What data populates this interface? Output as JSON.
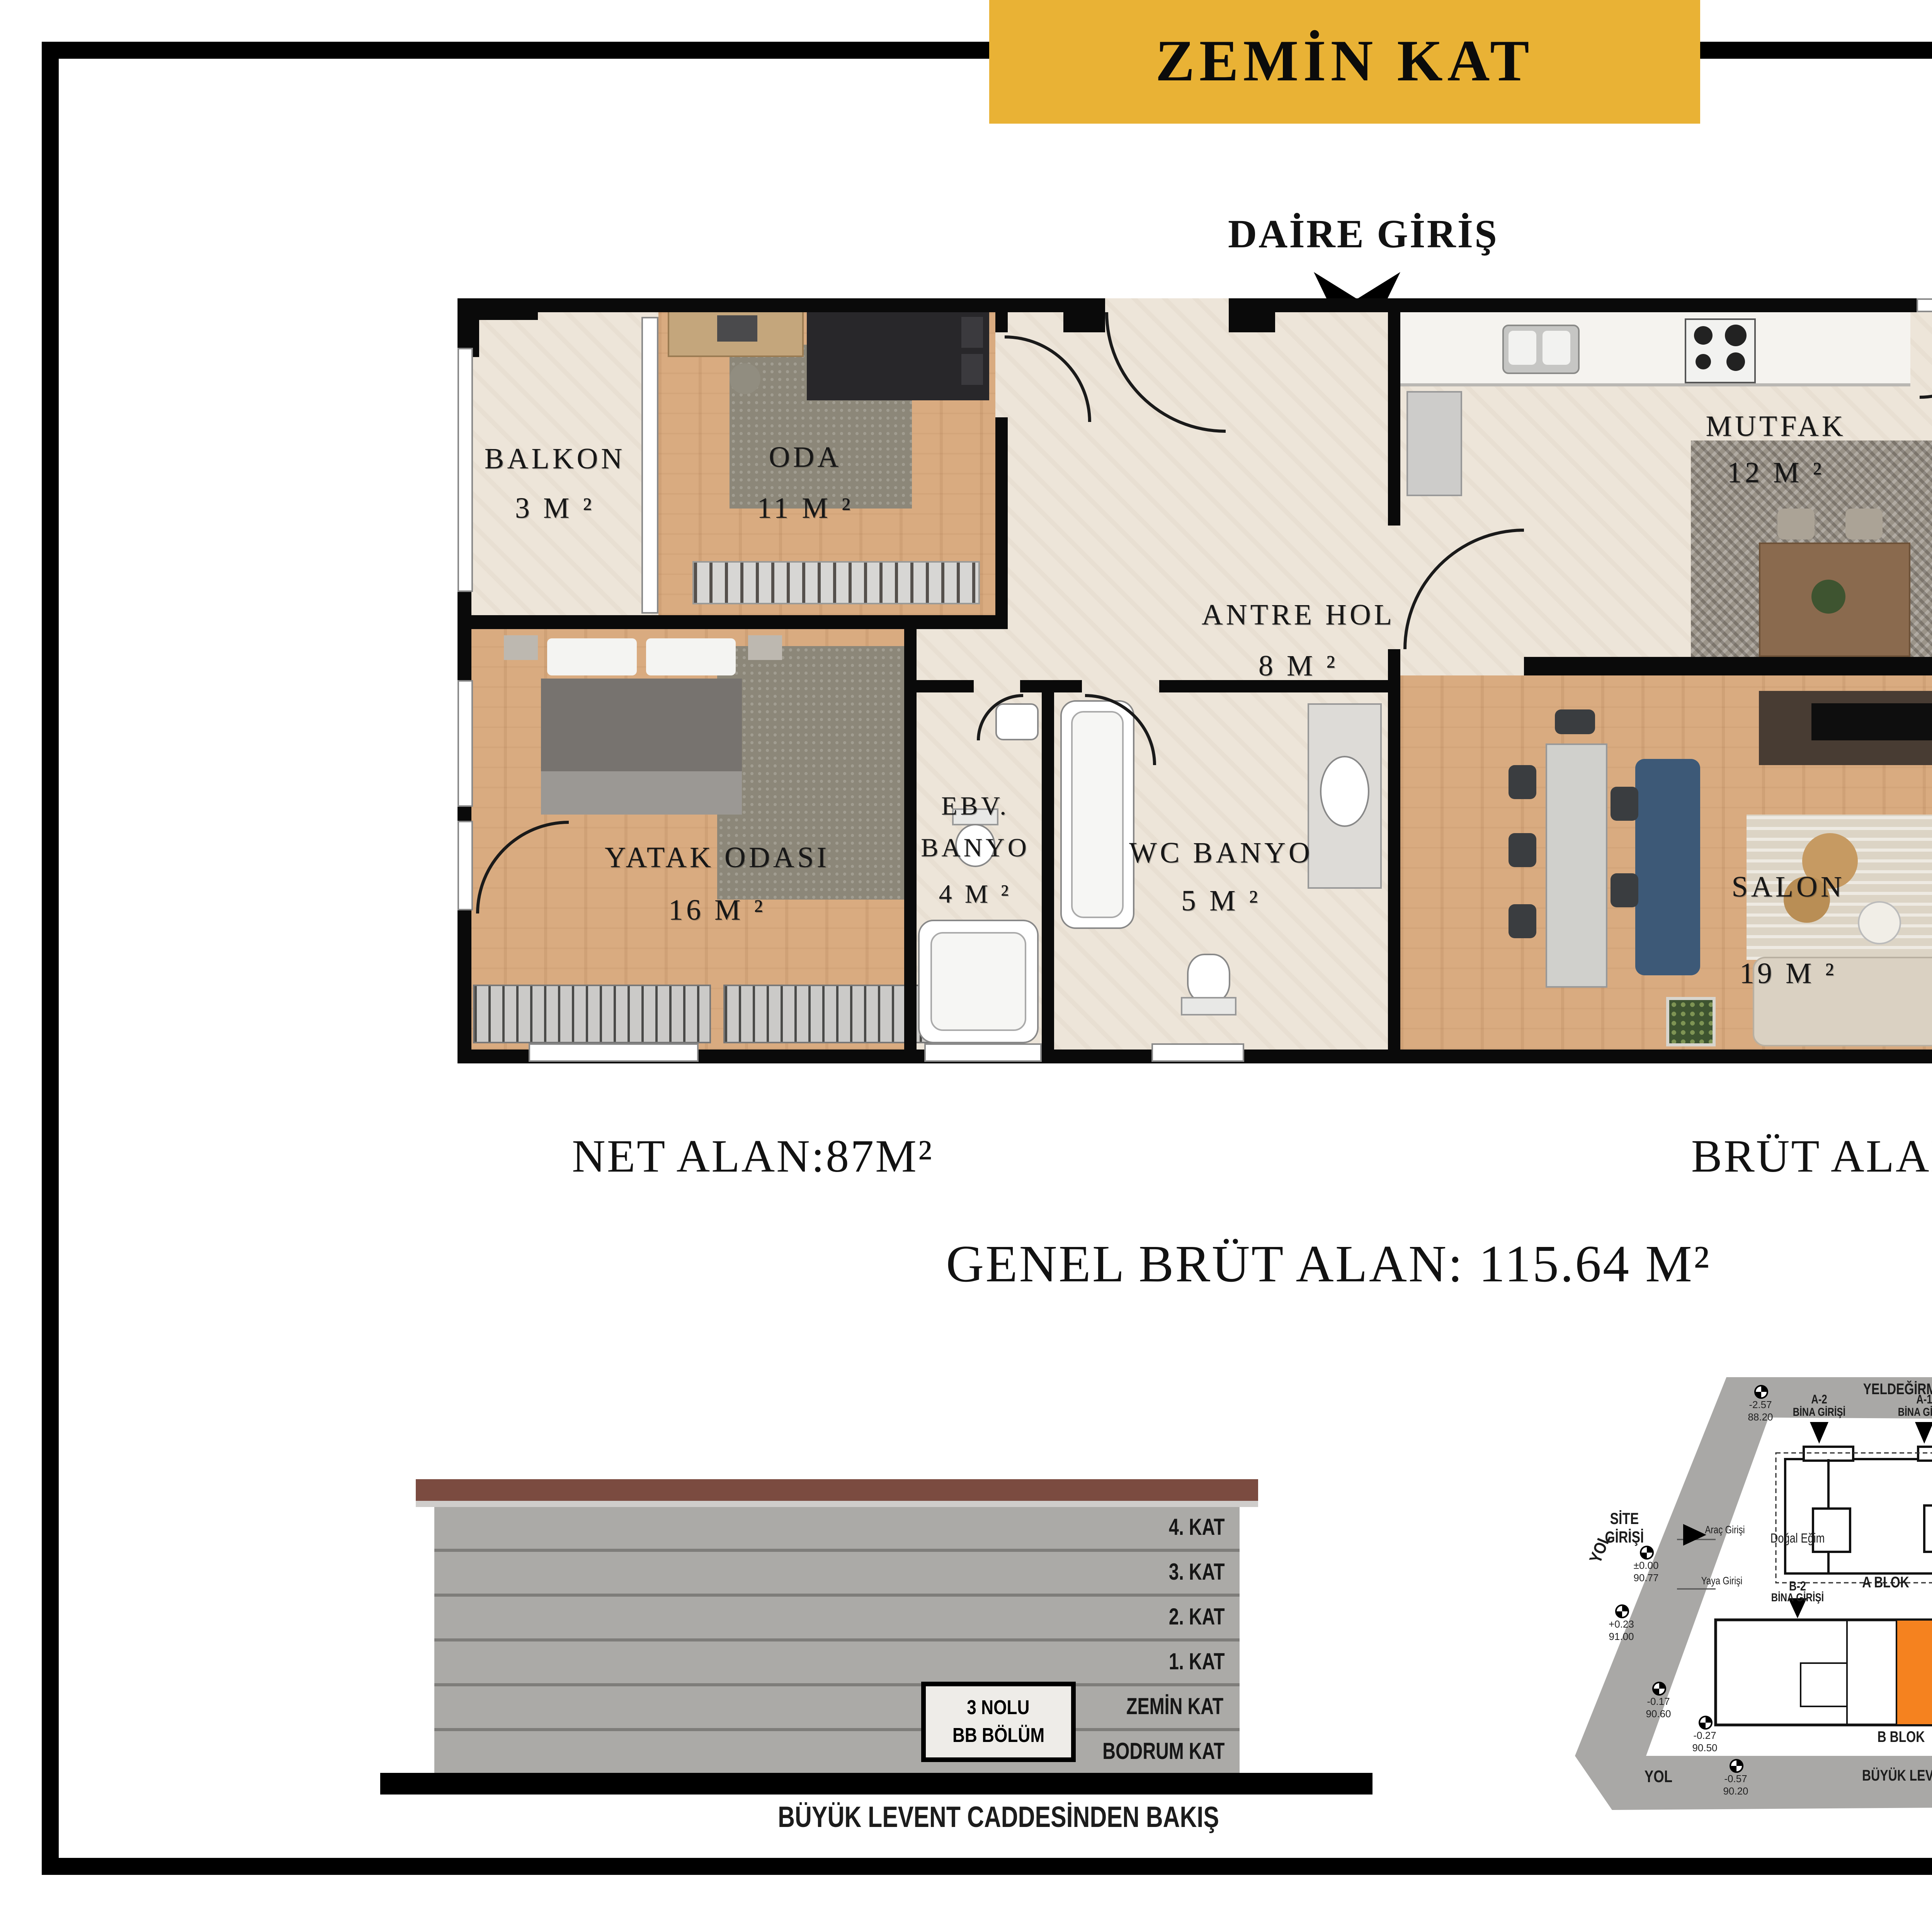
{
  "header": {
    "floor_title": "ZEMİN KAT",
    "entrance_label": "DAİRE GİRİŞ",
    "apartment_type": "2+1 DAİRE"
  },
  "floor_plan": {
    "rooms": {
      "balkon_small": {
        "name": "BALKON",
        "area": "3 M ²"
      },
      "oda": {
        "name": "ODA",
        "area": "11 M ²"
      },
      "antre": {
        "name": "ANTRE HOL",
        "area": "8 M ²"
      },
      "mutfak": {
        "name": "MUTFAK",
        "area": "12 M ²"
      },
      "balkon_big": {
        "name": "BALKON",
        "area": "8 M ²"
      },
      "yatak": {
        "name": "YATAK ODASI",
        "area": "16 M ²"
      },
      "ebv": {
        "name1": "EBV.",
        "name2": "BANYO",
        "area": "4 M ²"
      },
      "wc": {
        "name": "WC BANYO",
        "area": "5 M ²"
      },
      "salon": {
        "name": "SALON",
        "area": "19 M ²"
      }
    }
  },
  "areas": {
    "net": "NET ALAN:87M²",
    "brut": "BRÜT ALAN: 98 M²",
    "genel": "GENEL BRÜT ALAN: 115.64 M²"
  },
  "elevation": {
    "floors": [
      "4. KAT",
      "3. KAT",
      "2. KAT",
      "1. KAT",
      "ZEMİN KAT",
      "BODRUM KAT"
    ],
    "unit_line1": "3 NOLU",
    "unit_line2": "BB BÖLÜM",
    "caption": "BÜYÜK LEVENT CADDESİNDEN BAKIŞ"
  },
  "site_plan": {
    "caption": "VAZİYET",
    "street_top": "YELDEĞİRMENİ CADDESİ",
    "street_bottom": "BÜYÜK LEVENT CADDESİ",
    "road_label": "YOL",
    "site_entrance_line1": "SİTE",
    "site_entrance_line2": "GİRİŞİ",
    "natural_slope": "Doğal Eğim",
    "vehicle_entrance": "Araç Girişi",
    "pedestrian_entrance": "Yaya Girişi",
    "blocks": {
      "a": "A BLOK",
      "b": "B BLOK",
      "a2": "A-2",
      "a1": "A-1",
      "b2": "B-2",
      "b1": "B-1",
      "building_entrance": "BİNA GİRİŞİ"
    },
    "markers": [
      {
        "value": "-2.57",
        "elev": "88.20"
      },
      {
        "value": "-2.77",
        "elev": "88.00"
      },
      {
        "value": "-2.54",
        "elev": "88.23"
      },
      {
        "value": "-2.28",
        "elev": "88.49"
      },
      {
        "value": "±0.00",
        "elev": "90.77"
      },
      {
        "value": "+0.23",
        "elev": "91.00"
      },
      {
        "value": "-0.17",
        "elev": "90.60"
      },
      {
        "value": "-0.27",
        "elev": "90.50"
      },
      {
        "value": "-0.57",
        "elev": "90.20"
      },
      {
        "value": "-2.02",
        "elev": "88.75"
      },
      {
        "value": "-2.12",
        "elev": "88.65"
      }
    ]
  },
  "colors": {
    "banner": "#E9B235",
    "highlight_unit": "#F5821F",
    "wood_floor": "#D9AB80",
    "tile_floor": "#EDE5D9",
    "road_gray": "#A9A8A6"
  }
}
